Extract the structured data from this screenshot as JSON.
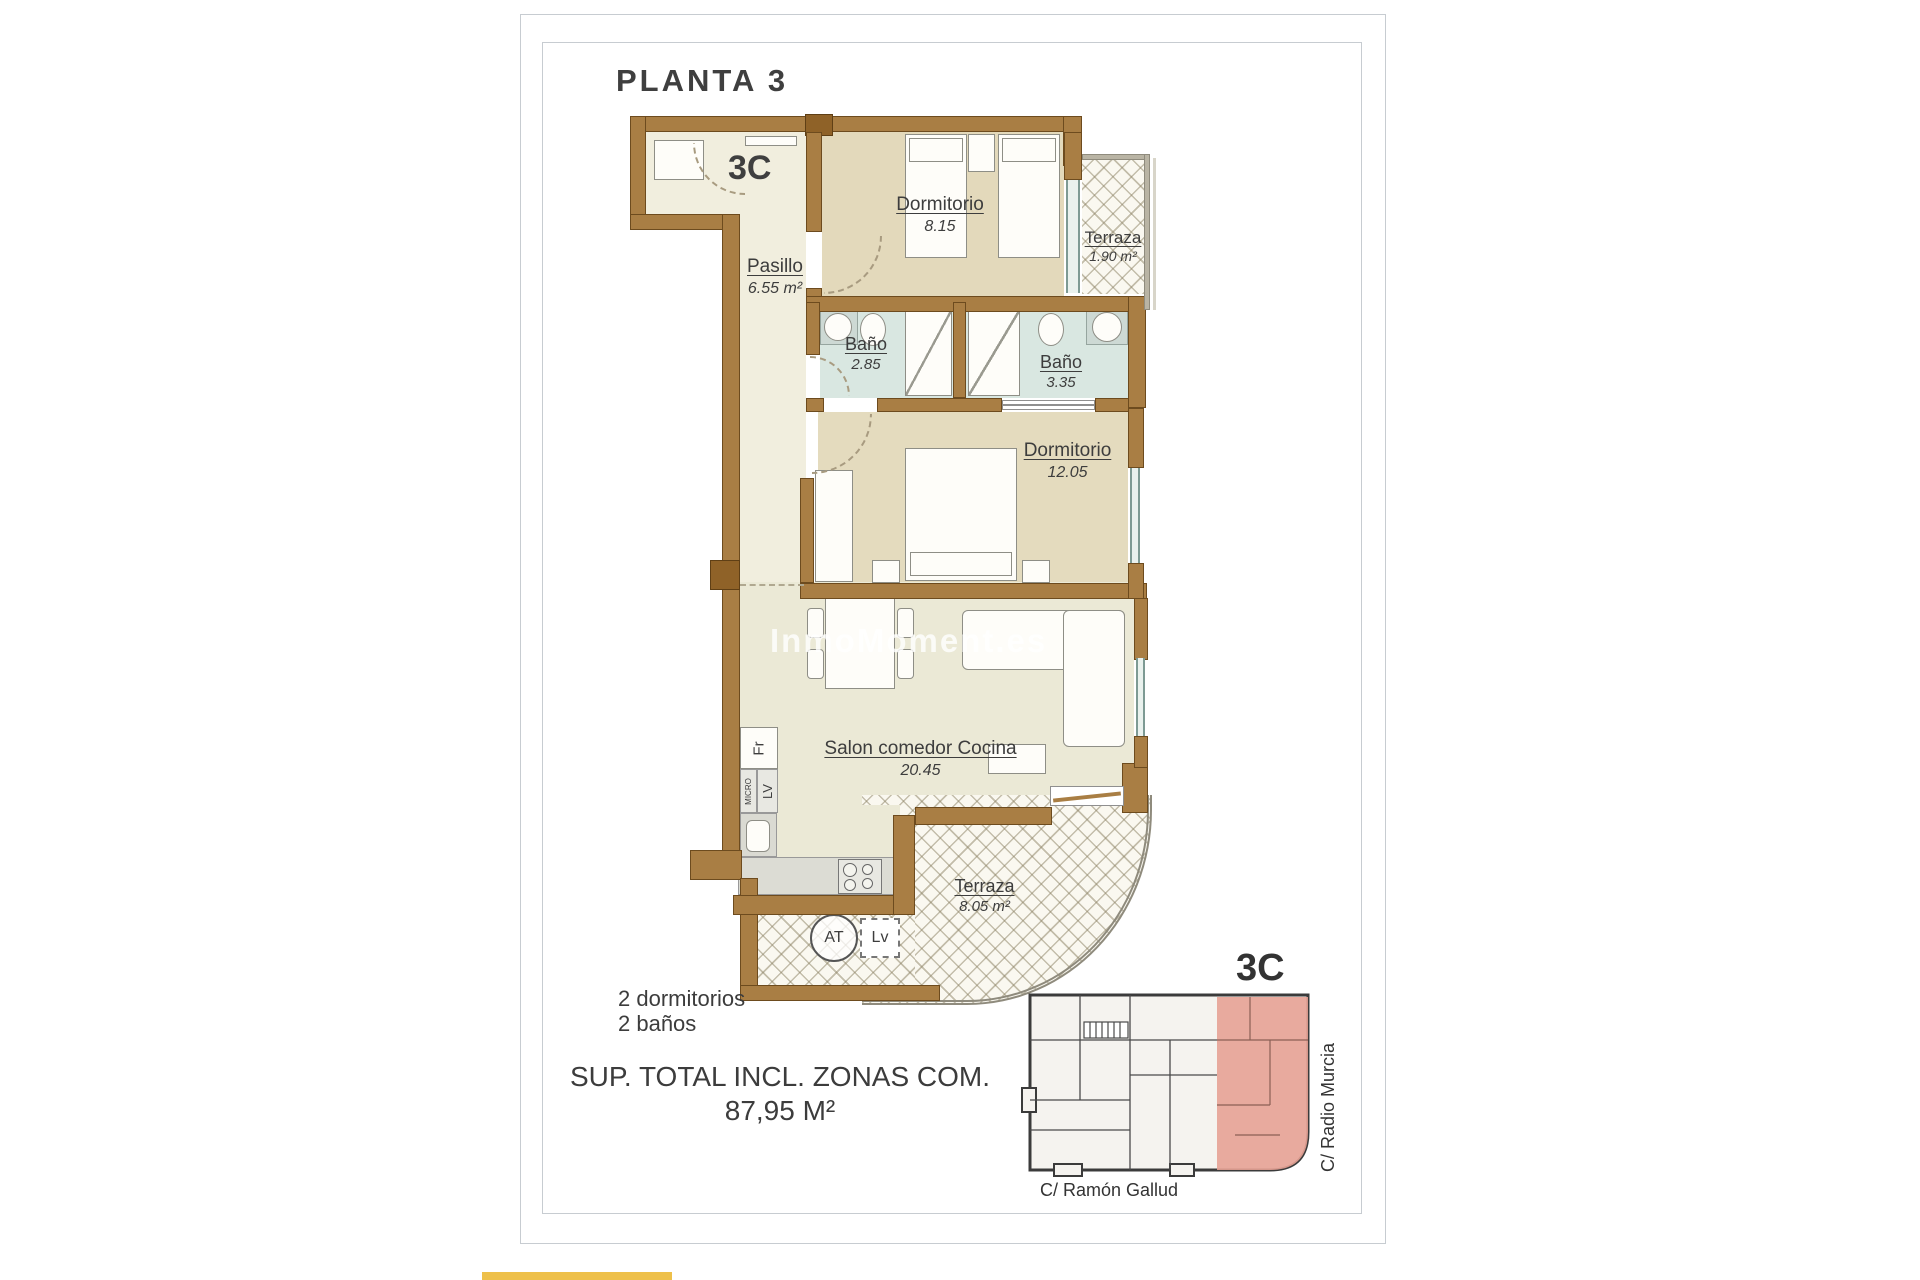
{
  "page": {
    "title": "PLANTA 3",
    "plan_unit": "3C",
    "watermark": "InmoMoment.es",
    "features": {
      "bedrooms": "2 dormitorios",
      "bathrooms": "2 baños"
    },
    "total": {
      "label": "SUP. TOTAL INCL. ZONAS COM.",
      "value": "87,95 M²"
    }
  },
  "rooms": {
    "pasillo": {
      "name": "Pasillo",
      "area": "6.55 m²"
    },
    "dormitorio1": {
      "name": "Dormitorio",
      "area": "8.15"
    },
    "terraza1": {
      "name": "Terraza",
      "area": "1.90 m²"
    },
    "bano1": {
      "name": "Baño",
      "area": "2.85"
    },
    "bano2": {
      "name": "Baño",
      "area": "3.35"
    },
    "dormitorio2": {
      "name": "Dormitorio",
      "area": "12.05"
    },
    "salon": {
      "name": "Salon comedor Cocina",
      "area": "20.45"
    },
    "terraza2": {
      "name": "Terraza",
      "area": "8.05 m²"
    }
  },
  "appliances": {
    "fridge": "Fr",
    "microwave": "MICRO",
    "dishwasher": "LV",
    "water_heater": "AT",
    "washing_machine": "Lv"
  },
  "keyplan": {
    "unit": "3C",
    "street_bottom": "C/ Ramón Gallud",
    "street_right": "C/ Radio Murcia"
  },
  "colors": {
    "wall": "#a97e44",
    "wall_dark": "#8f6228",
    "hall_floor": "#f1eede",
    "bedroom_floor": "#e3d9bb",
    "bath_floor": "#d9e7e1",
    "salon_floor": "#ebe9d6",
    "tile_base": "#faf8f0",
    "window_glass": "#7d9a93",
    "unit_highlight": "#e7a295",
    "accent_strip": "#eec04a"
  }
}
